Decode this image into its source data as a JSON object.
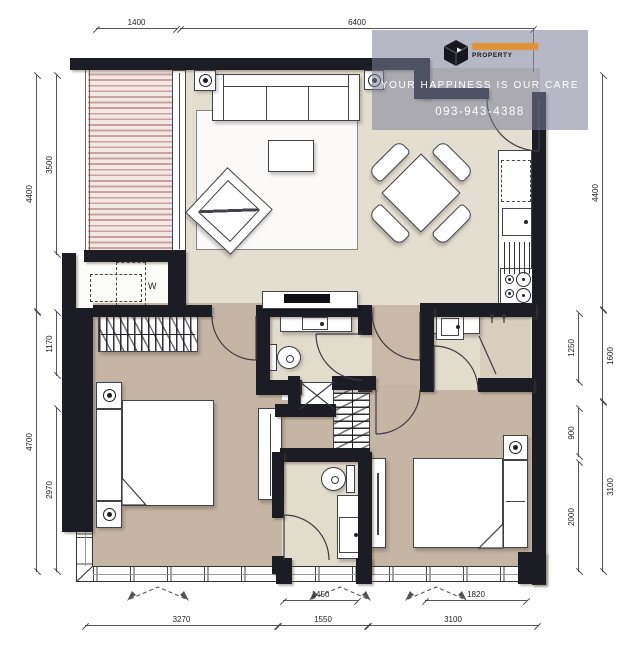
{
  "watermark": {
    "brand": "PROPERTY",
    "tagline": "YOUR HAPPINESS IS OUR CARE",
    "phone": "093-943-4388"
  },
  "labels": {
    "washer": "W"
  },
  "dimensions": {
    "top": [
      "1400",
      "6400"
    ],
    "left_outer": [
      "4400",
      "4700"
    ],
    "left_inner": [
      "3500",
      "1170",
      "2970"
    ],
    "right_inner": [
      "1250",
      "900",
      "2000"
    ],
    "right_outer": [
      "4400",
      "1600",
      "3100"
    ],
    "bottom_inner": [
      "1450",
      "1820"
    ],
    "bottom_outer": [
      "3270",
      "1550",
      "3100"
    ]
  },
  "colors": {
    "wall": "#1c1c25",
    "floor_living": "#e4ded0",
    "floor_bedroom": "#c5b5a5",
    "floor_bath": "#e2dccd",
    "floor_shower": "#d7cebe",
    "balcony_stripe": "#c9a29e",
    "accent_orange": "#e09036",
    "watermark_bg": "#7a80a0"
  }
}
